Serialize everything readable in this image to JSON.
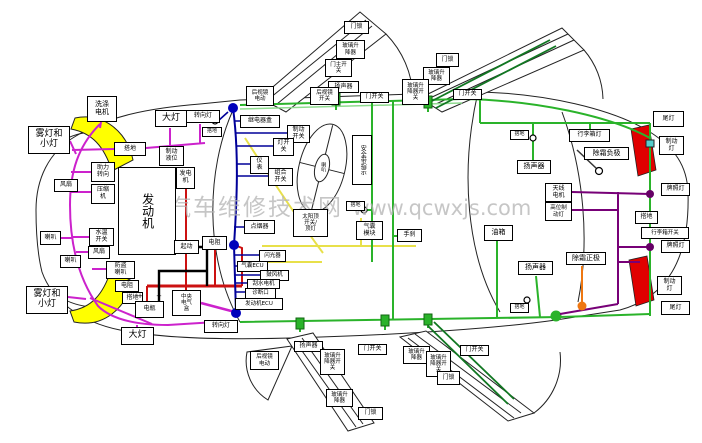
{
  "watermark": {
    "text_cn": "汽车维修技术网",
    "text_url": "www.qcwxjs.com"
  },
  "palette": {
    "front_harness": "#cc22cc",
    "dash_harness": "#000099",
    "power_wire": "#cc1111",
    "ground_cable": "#000000",
    "signal_wire": "#e8e04a",
    "body_harness": "#2ab32a",
    "rear_harness": "#770077",
    "defroster_feed": "#ee7711",
    "headlamp_fill": "#ffff00",
    "taillamp_fill": "#e00000"
  },
  "labels": [
    {
      "name": "washer-motor",
      "text": "洗涤\n电机",
      "x": 87,
      "y": 96,
      "w": 30,
      "h": 26,
      "fs": 7
    },
    {
      "name": "fog-small-light-top",
      "text": "雾灯和\n小灯",
      "x": 28,
      "y": 126,
      "w": 42,
      "h": 28,
      "fs": 9
    },
    {
      "name": "ground-front",
      "text": "搭地",
      "x": 114,
      "y": 142,
      "w": 32,
      "h": 14
    },
    {
      "name": "power-steering",
      "text": "助力\n转向",
      "x": 91,
      "y": 162,
      "w": 24,
      "h": 20
    },
    {
      "name": "ac-compressor",
      "text": "压缩\n机",
      "x": 91,
      "y": 184,
      "w": 24,
      "h": 20
    },
    {
      "name": "fan-1",
      "text": "风扇",
      "x": 54,
      "y": 179,
      "w": 24,
      "h": 13
    },
    {
      "name": "headlight-top",
      "text": "大灯",
      "x": 155,
      "y": 110,
      "w": 32,
      "h": 17,
      "fs": 9
    },
    {
      "name": "turn-light-top",
      "text": "转向灯",
      "x": 186,
      "y": 110,
      "w": 34,
      "h": 13
    },
    {
      "name": "ground-cowl",
      "text": "搭地",
      "x": 202,
      "y": 127,
      "w": 20,
      "h": 10,
      "fs": 5
    },
    {
      "name": "brake-fluid-level",
      "text": "制动\n液位",
      "x": 159,
      "y": 146,
      "w": 25,
      "h": 20
    },
    {
      "name": "generator",
      "text": "发电\n机",
      "x": 176,
      "y": 167,
      "w": 19,
      "h": 22
    },
    {
      "name": "engine",
      "text": "发动机",
      "x": 118,
      "y": 167,
      "w": 58,
      "h": 88,
      "v": true,
      "fs": 12
    },
    {
      "name": "starter",
      "text": "起动",
      "x": 174,
      "y": 240,
      "w": 25,
      "h": 14
    },
    {
      "name": "resistor-2",
      "text": "电阻",
      "x": 202,
      "y": 236,
      "w": 25,
      "h": 14
    },
    {
      "name": "coolant-temp-switch",
      "text": "水温\n开关",
      "x": 89,
      "y": 228,
      "w": 25,
      "h": 18
    },
    {
      "name": "fan-2",
      "text": "风扇",
      "x": 88,
      "y": 246,
      "w": 22,
      "h": 13
    },
    {
      "name": "horn-1",
      "text": "喇叭",
      "x": 40,
      "y": 231,
      "w": 21,
      "h": 14
    },
    {
      "name": "horn-2",
      "text": "喇叭",
      "x": 60,
      "y": 255,
      "w": 21,
      "h": 13
    },
    {
      "name": "anti-theft-horn",
      "text": "防盗\n喇叭",
      "x": 106,
      "y": 261,
      "w": 29,
      "h": 18
    },
    {
      "name": "resistor-1",
      "text": "电阻",
      "x": 115,
      "y": 280,
      "w": 24,
      "h": 12
    },
    {
      "name": "ground-battery",
      "text": "搭地",
      "x": 122,
      "y": 292,
      "w": 21,
      "h": 12
    },
    {
      "name": "battery",
      "text": "电瓶",
      "x": 135,
      "y": 301,
      "w": 29,
      "h": 17
    },
    {
      "name": "battery-plus",
      "text": "+",
      "x": 136,
      "y": 292,
      "w": 8,
      "h": 9,
      "plain": true,
      "fs": 7
    },
    {
      "name": "battery-minus",
      "text": "−",
      "x": 155,
      "y": 292,
      "w": 8,
      "h": 9,
      "plain": true,
      "fs": 7
    },
    {
      "name": "central-electrical-box",
      "text": "中央\n电气\n盒",
      "x": 172,
      "y": 290,
      "w": 29,
      "h": 26,
      "fs": 5.5
    },
    {
      "name": "turn-light-bottom",
      "text": "转向灯",
      "x": 204,
      "y": 320,
      "w": 34,
      "h": 13
    },
    {
      "name": "headlight-bottom",
      "text": "大灯",
      "x": 121,
      "y": 327,
      "w": 33,
      "h": 18,
      "fs": 9
    },
    {
      "name": "fog-small-light-bottom",
      "text": "雾灯和\n小灯",
      "x": 26,
      "y": 286,
      "w": 42,
      "h": 28,
      "fs": 9
    },
    {
      "name": "relay-box",
      "text": "继电器盒",
      "x": 240,
      "y": 115,
      "w": 40,
      "h": 13
    },
    {
      "name": "brake-switch",
      "text": "制动\n开关",
      "x": 287,
      "y": 125,
      "w": 23,
      "h": 18
    },
    {
      "name": "light-switch",
      "text": "灯开\n关",
      "x": 273,
      "y": 138,
      "w": 21,
      "h": 18
    },
    {
      "name": "instrument-cluster",
      "text": "仪\n表",
      "x": 250,
      "y": 156,
      "w": 19,
      "h": 18
    },
    {
      "name": "combination-switch",
      "text": "组合\n开关",
      "x": 268,
      "y": 168,
      "w": 25,
      "h": 18
    },
    {
      "name": "cigarette-lighter",
      "text": "点烟器",
      "x": 244,
      "y": 220,
      "w": 31,
      "h": 14
    },
    {
      "name": "flasher",
      "text": "闪光器",
      "x": 259,
      "y": 250,
      "w": 27,
      "h": 12,
      "fs": 5.5
    },
    {
      "name": "airbag-ecu",
      "text": "气囊ECU",
      "x": 237,
      "y": 261,
      "w": 31,
      "h": 11,
      "fs": 5.5
    },
    {
      "name": "blower-motor",
      "text": "鼓风机",
      "x": 260,
      "y": 270,
      "w": 29,
      "h": 11,
      "fs": 5.5
    },
    {
      "name": "wiper-motor",
      "text": "刮水电机",
      "x": 247,
      "y": 279,
      "w": 33,
      "h": 10,
      "fs": 5.5
    },
    {
      "name": "diagnostic-port",
      "text": "诊断口",
      "x": 245,
      "y": 288,
      "w": 31,
      "h": 11,
      "fs": 5.5
    },
    {
      "name": "engine-ecu",
      "text": "发动机ECU",
      "x": 235,
      "y": 298,
      "w": 48,
      "h": 12,
      "fs": 5.5
    },
    {
      "name": "horn-pad",
      "text": "喇叭",
      "x": 317,
      "y": 154,
      "w": 11,
      "h": 26,
      "v": true,
      "plain": true,
      "fs": 5
    },
    {
      "name": "seat-belt-indicator",
      "text": "安全带指示",
      "x": 352,
      "y": 135,
      "w": 20,
      "h": 50,
      "v": true
    },
    {
      "name": "sunroof-switch",
      "text": "太阳顶\n开关/\n顶灯",
      "x": 293,
      "y": 209,
      "w": 35,
      "h": 28,
      "fs": 5.5
    },
    {
      "name": "ground-floor",
      "text": "搭地",
      "x": 346,
      "y": 201,
      "w": 19,
      "h": 10,
      "fs": 5
    },
    {
      "name": "airbag-module",
      "text": "气囊\n模块",
      "x": 356,
      "y": 221,
      "w": 27,
      "h": 19
    },
    {
      "name": "handbrake",
      "text": "手刹",
      "x": 397,
      "y": 229,
      "w": 25,
      "h": 13
    },
    {
      "name": "mirror-motor-top",
      "text": "后视镜\n电动",
      "x": 246,
      "y": 86,
      "w": 28,
      "h": 20,
      "fs": 5.5
    },
    {
      "name": "door-lock-top-front",
      "text": "门锁",
      "x": 344,
      "y": 21,
      "w": 25,
      "h": 13
    },
    {
      "name": "window-lifter-top-front",
      "text": "玻璃升\n降器",
      "x": 336,
      "y": 40,
      "w": 29,
      "h": 19,
      "fs": 5.5
    },
    {
      "name": "door-master-switch",
      "text": "门主开\n关",
      "x": 325,
      "y": 59,
      "w": 27,
      "h": 18,
      "fs": 5.5
    },
    {
      "name": "speaker-top-front",
      "text": "扬声器",
      "x": 328,
      "y": 81,
      "w": 31,
      "h": 12
    },
    {
      "name": "mirror-switch",
      "text": "后视镜\n开关",
      "x": 310,
      "y": 87,
      "w": 29,
      "h": 18,
      "fs": 5.5
    },
    {
      "name": "door-switch-top-1",
      "text": "门开关",
      "x": 360,
      "y": 92,
      "w": 29,
      "h": 11
    },
    {
      "name": "door-switch-top-2",
      "text": "门开关",
      "x": 453,
      "y": 89,
      "w": 29,
      "h": 11
    },
    {
      "name": "door-lock-top-rear",
      "text": "门锁",
      "x": 436,
      "y": 53,
      "w": 23,
      "h": 14
    },
    {
      "name": "window-lifter-top-rear",
      "text": "玻璃升\n降器",
      "x": 423,
      "y": 67,
      "w": 27,
      "h": 18,
      "fs": 5.5
    },
    {
      "name": "window-switch-top-rear",
      "text": "玻璃升\n降器开\n关",
      "x": 402,
      "y": 79,
      "w": 27,
      "h": 26,
      "fs": 5.5
    },
    {
      "name": "mirror-motor-bottom",
      "text": "后视镜\n电动",
      "x": 250,
      "y": 351,
      "w": 29,
      "h": 19,
      "fs": 5.5
    },
    {
      "name": "speaker-bottom-front",
      "text": "扬声器",
      "x": 294,
      "y": 341,
      "w": 29,
      "h": 11
    },
    {
      "name": "window-switch-bottom-front",
      "text": "玻璃升\n降器开\n关",
      "x": 320,
      "y": 349,
      "w": 25,
      "h": 26,
      "fs": 5.5
    },
    {
      "name": "door-switch-bottom-1",
      "text": "门开关",
      "x": 358,
      "y": 344,
      "w": 29,
      "h": 11
    },
    {
      "name": "window-lifter-bottom-front",
      "text": "玻璃升\n降器",
      "x": 326,
      "y": 389,
      "w": 27,
      "h": 18,
      "fs": 5.5
    },
    {
      "name": "door-lock-bottom-front",
      "text": "门锁",
      "x": 358,
      "y": 407,
      "w": 25,
      "h": 13
    },
    {
      "name": "window-lifter-bottom-rear",
      "text": "玻璃升\n降器",
      "x": 403,
      "y": 346,
      "w": 27,
      "h": 18,
      "fs": 5.5
    },
    {
      "name": "window-switch-bottom-rear",
      "text": "玻璃升\n降器开\n关",
      "x": 426,
      "y": 351,
      "w": 25,
      "h": 26,
      "fs": 5.5
    },
    {
      "name": "door-lock-bottom-rear",
      "text": "门锁",
      "x": 437,
      "y": 371,
      "w": 23,
      "h": 14
    },
    {
      "name": "door-switch-bottom-2",
      "text": "门开关",
      "x": 460,
      "y": 345,
      "w": 29,
      "h": 11
    },
    {
      "name": "ground-rear-deck",
      "text": "搭地",
      "x": 510,
      "y": 130,
      "w": 19,
      "h": 10,
      "fs": 5
    },
    {
      "name": "speaker-rear-left",
      "text": "扬声器",
      "x": 517,
      "y": 160,
      "w": 34,
      "h": 14,
      "fs": 7
    },
    {
      "name": "trunk-light",
      "text": "行李箱灯",
      "x": 569,
      "y": 129,
      "w": 41,
      "h": 13
    },
    {
      "name": "defroster-negative",
      "text": "除霜负极",
      "x": 584,
      "y": 147,
      "w": 45,
      "h": 13,
      "fs": 7
    },
    {
      "name": "antenna-motor",
      "text": "天线\n电机",
      "x": 545,
      "y": 183,
      "w": 27,
      "h": 19
    },
    {
      "name": "high-brake-light",
      "text": "高位制\n动灯",
      "x": 545,
      "y": 202,
      "w": 27,
      "h": 19,
      "fs": 5.5
    },
    {
      "name": "fuel-tank",
      "text": "油箱",
      "x": 484,
      "y": 225,
      "w": 29,
      "h": 16,
      "fs": 7
    },
    {
      "name": "speaker-rear-bottom",
      "text": "扬声器",
      "x": 518,
      "y": 261,
      "w": 35,
      "h": 14,
      "fs": 7
    },
    {
      "name": "defroster-positive",
      "text": "除霜正极",
      "x": 566,
      "y": 252,
      "w": 40,
      "h": 13,
      "fs": 7
    },
    {
      "name": "ground-rear-floor",
      "text": "搭地",
      "x": 510,
      "y": 303,
      "w": 19,
      "h": 10,
      "fs": 5
    },
    {
      "name": "tail-light-top",
      "text": "尾灯",
      "x": 653,
      "y": 111,
      "w": 31,
      "h": 16
    },
    {
      "name": "brake-light-top",
      "text": "制动\n灯",
      "x": 659,
      "y": 136,
      "w": 25,
      "h": 19
    },
    {
      "name": "license-light-1",
      "text": "牌照灯",
      "x": 661,
      "y": 183,
      "w": 29,
      "h": 13
    },
    {
      "name": "ground-rear-right",
      "text": "搭地",
      "x": 635,
      "y": 211,
      "w": 23,
      "h": 13
    },
    {
      "name": "trunk-switch",
      "text": "行李箱开关",
      "x": 641,
      "y": 227,
      "w": 48,
      "h": 12,
      "fs": 5.5
    },
    {
      "name": "license-light-2",
      "text": "牌照灯",
      "x": 661,
      "y": 240,
      "w": 29,
      "h": 13
    },
    {
      "name": "brake-light-bottom",
      "text": "制动\n灯",
      "x": 657,
      "y": 276,
      "w": 25,
      "h": 19
    },
    {
      "name": "tail-light-bottom",
      "text": "尾灯",
      "x": 661,
      "y": 301,
      "w": 29,
      "h": 14
    }
  ]
}
